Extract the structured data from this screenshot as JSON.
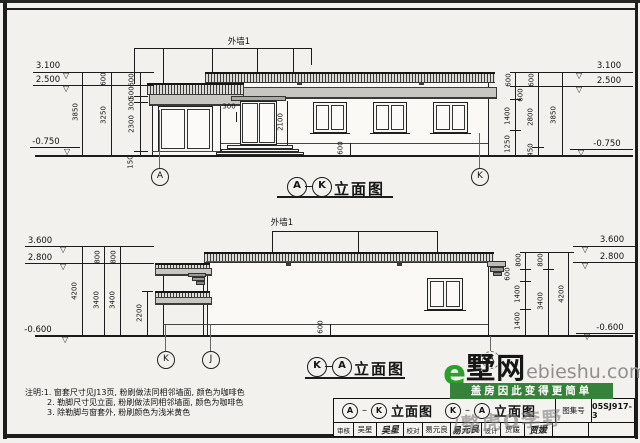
{
  "colors": {
    "paper": "#f2f1ed",
    "line": "#1c1c1c",
    "banner_green": "#37823a",
    "logo_green": "#2ca02c"
  },
  "top": {
    "wall_label": "外墙1",
    "levels": [
      "3.100",
      "2.500",
      "-0.750"
    ],
    "dl": [
      "3850",
      "600",
      "3250",
      "600",
      "500",
      "300",
      "2300",
      "150"
    ],
    "dr": [
      "600",
      "600",
      "1400",
      "1250",
      "600",
      "2800",
      "450",
      "3850"
    ],
    "di": [
      "300",
      "2100",
      "600"
    ],
    "bubbles": [
      "A",
      "K"
    ],
    "title": {
      "a": "A",
      "b": "K",
      "t": "立面图"
    }
  },
  "bottom": {
    "wall_label": "外墙1",
    "levels": [
      "3.600",
      "2.800",
      "-0.600"
    ],
    "dl": [
      "4200",
      "800",
      "3400",
      "800",
      "3400",
      "2200"
    ],
    "dr": [
      "800",
      "600",
      "1400",
      "1400",
      "800",
      "3400",
      "4200"
    ],
    "di": [
      "600"
    ],
    "bubbles": [
      "K",
      "J",
      "A"
    ],
    "title": {
      "a": "K",
      "b": "A",
      "t": "立面图"
    }
  },
  "notes": {
    "l1": "注明:1. 窗套尺寸见J13页, 粉刷做法同相邻墙面, 颜色为咖啡色",
    "l2": "2. 勒脚尺寸见立面, 粉刷做法同相邻墙面, 颜色为咖啡色",
    "l3": "3. 除勒脚与窗套外, 粉刷颜色为浅米黄色"
  },
  "tb": {
    "t1": {
      "a": "A",
      "b": "K",
      "t": "立面图"
    },
    "t2": {
      "a": "K",
      "b": "A",
      "t": "立面图"
    },
    "atlas_label": "图集号",
    "atlas_value": "05SJ917-3",
    "r1": "审核",
    "r1n": "吴星",
    "r1s": "吴星",
    "r2": "校对",
    "r2n": "易元良",
    "r2s": "易元良",
    "r3": "设计",
    "r3n": "贾媛",
    "r3s": "贾媛"
  },
  "brand": {
    "e": "e",
    "name": "墅网",
    "domain": "ebieshu.com",
    "slogan": "盖房因此变得更简单"
  },
  "watermark": "/整虎O李野"
}
